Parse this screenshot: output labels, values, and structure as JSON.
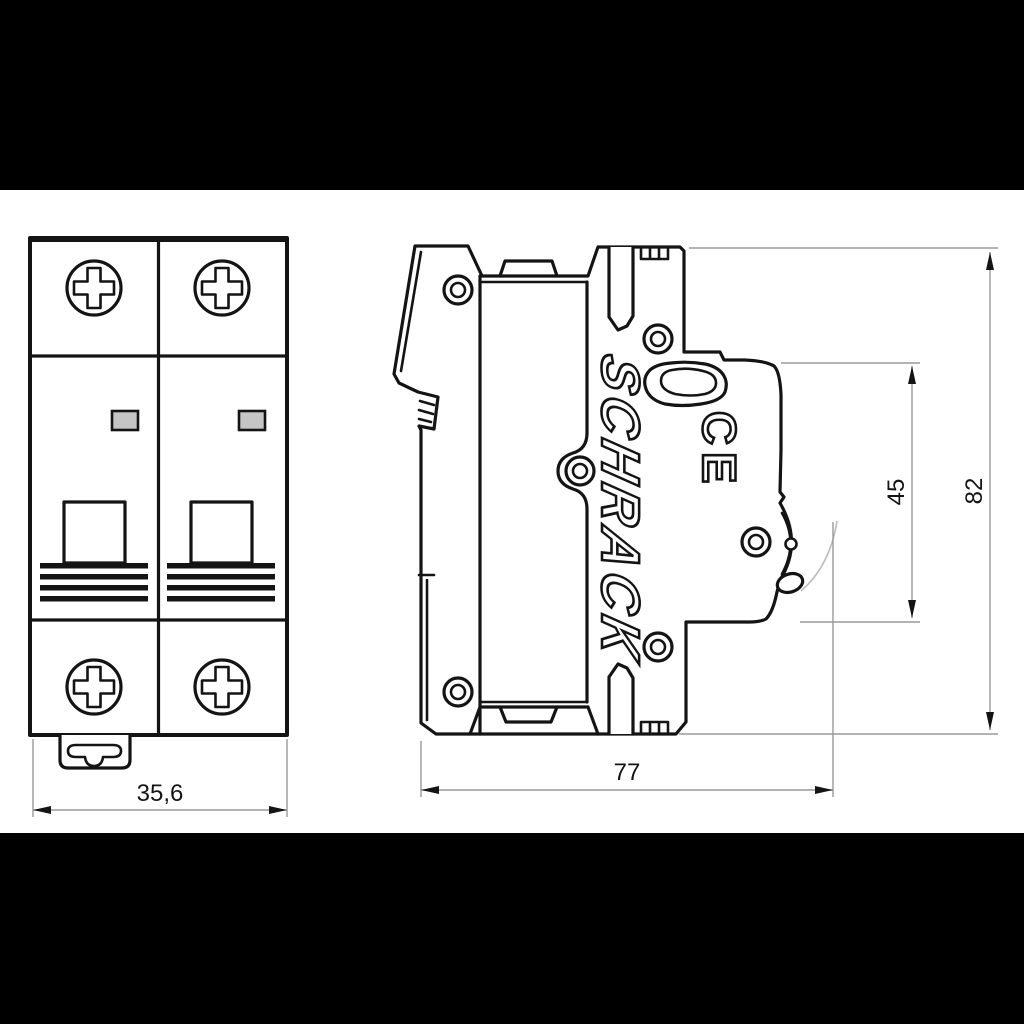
{
  "drawing": {
    "brand_logo": "SCHRACK",
    "ce_mark": "CE",
    "dimensions": {
      "front_width": "35,6",
      "depth": "77",
      "upper_height": "45",
      "overall_height": "82"
    },
    "colors": {
      "letterbox": "#000000",
      "background": "#ffffff",
      "line": "#141414",
      "dimension_line": "#9a9a9a",
      "indicator_fill": "#c5c5c5",
      "travel_arc": "#bdbdbd"
    }
  }
}
